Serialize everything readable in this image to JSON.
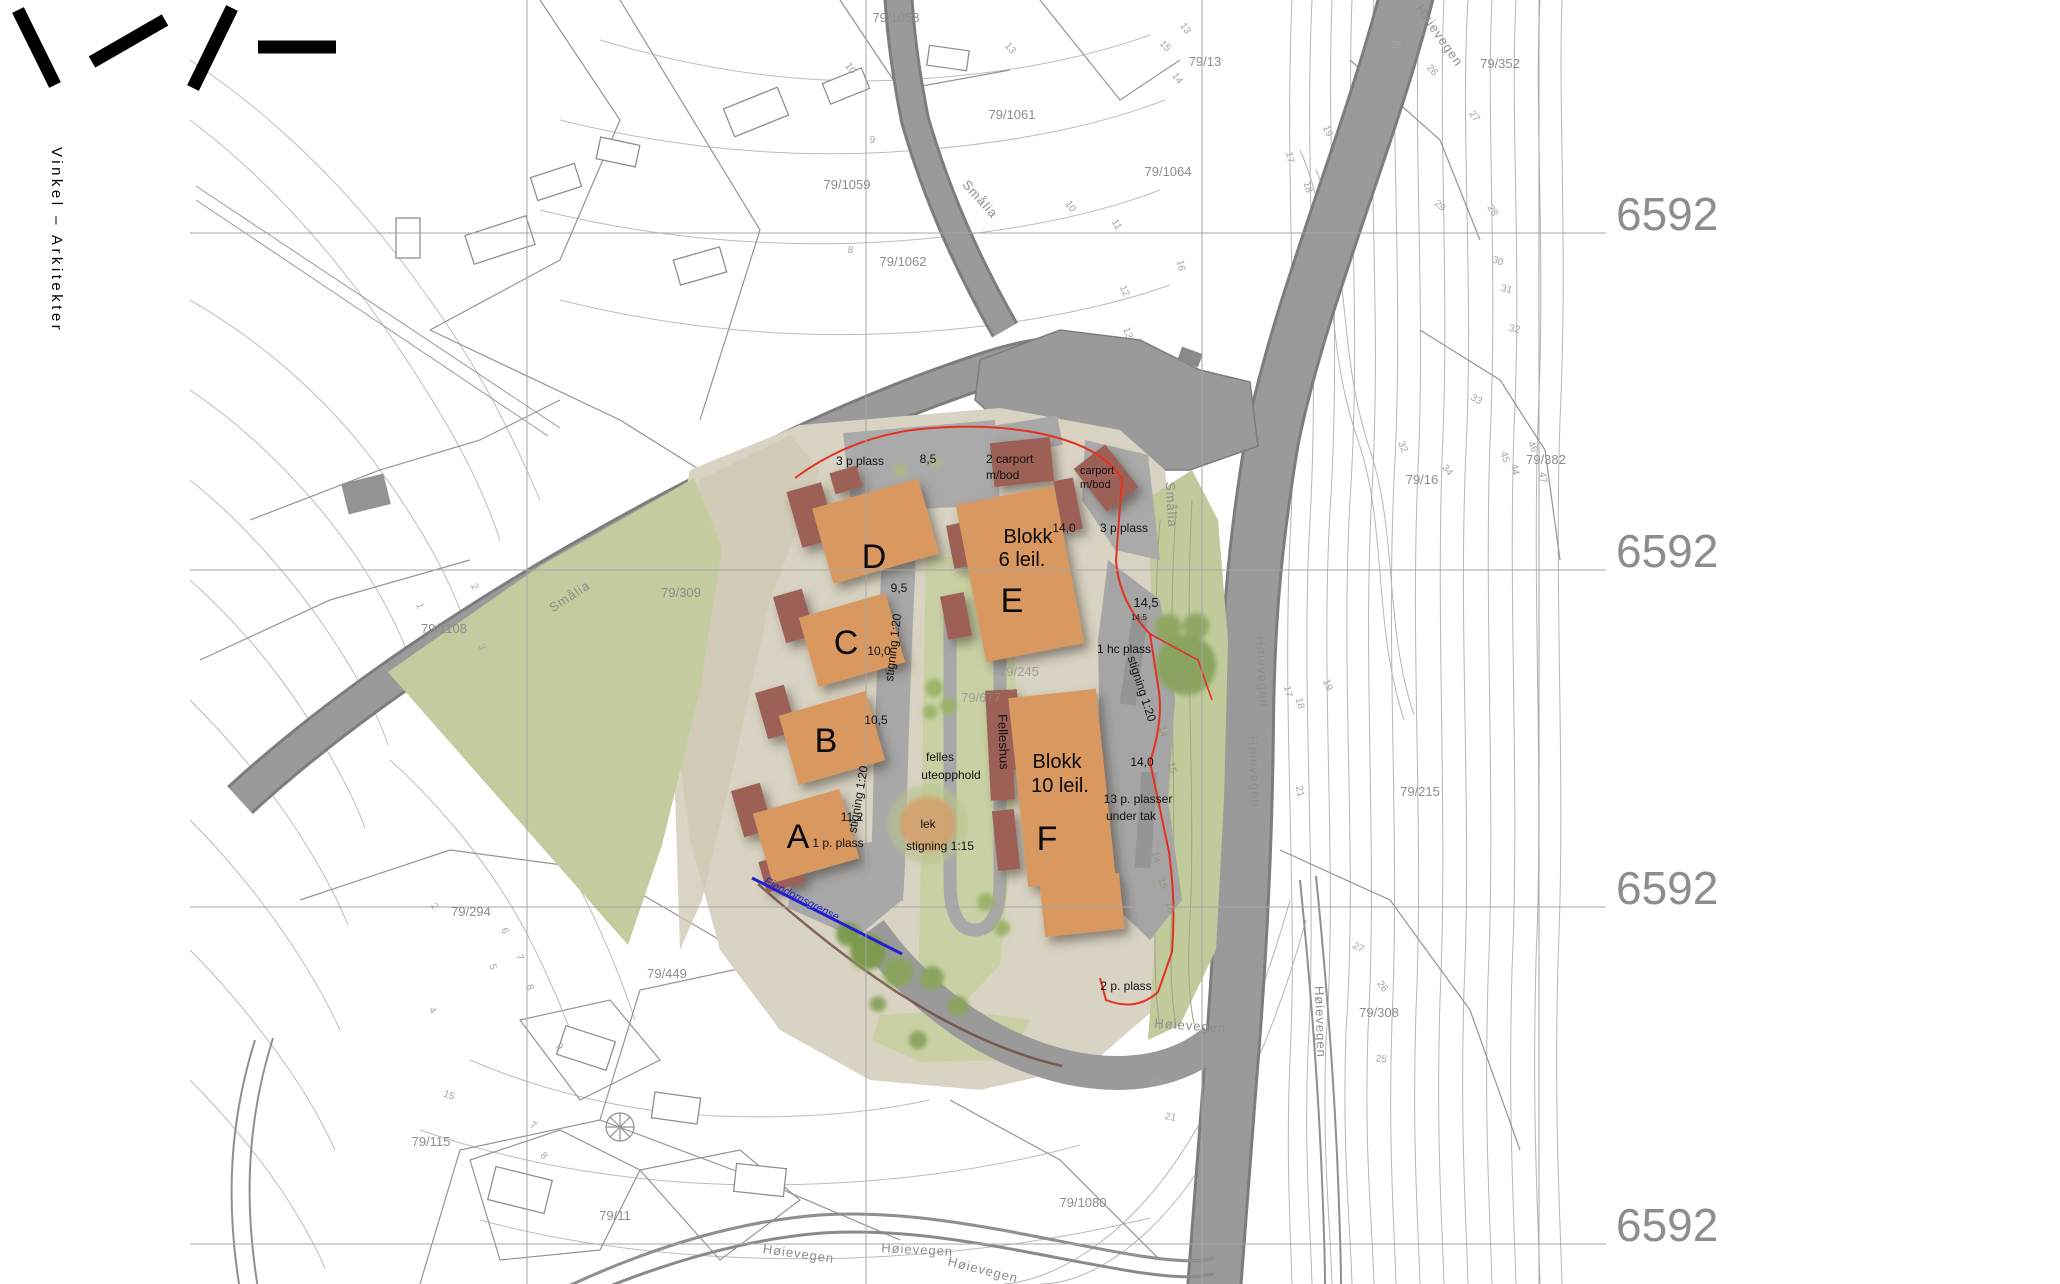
{
  "brand": {
    "studio": "Vinkel – Arkitekter"
  },
  "grid": {
    "labels": [
      {
        "t": "6592"
      },
      {
        "t": "6592"
      },
      {
        "t": "6592"
      },
      {
        "t": "6592"
      }
    ]
  },
  "plan": {
    "building_letters": [
      {
        "t": "D"
      },
      {
        "t": "C"
      },
      {
        "t": "B"
      },
      {
        "t": "A"
      },
      {
        "t": "E"
      },
      {
        "t": "F"
      }
    ],
    "blocks": [
      {
        "line1": "Blokk",
        "line2": "6 leil."
      },
      {
        "line1": "Blokk",
        "line2": "10 leil."
      }
    ],
    "felleshus": "Felleshus",
    "annotations": {
      "p3_top": "3 p plass",
      "h85": "8,5",
      "carport2_l1": "2 carport",
      "carport2_l2": "m/bod",
      "carport_l1": "carport",
      "carport_l2": "m/bod",
      "w140_top": "14,0",
      "p3_right": "3 p plass",
      "h95": "9,5",
      "stigning120_a": "stigning 1:20",
      "h100": "10,0",
      "h105": "10,5",
      "stigning120_b": "stigning 1:20",
      "h112": "11,2",
      "p1": "1 p. plass",
      "felles_l1": "felles",
      "felles_l2": "uteopphold",
      "lek": "lek",
      "stigning115": "stigning 1:15",
      "h145": "14,5",
      "h145_small": "14,5",
      "hc": "1 hc plass",
      "stigning120_c": "stigning 1:20",
      "w140_right": "14,0",
      "p13_l1": "13 p. plasser",
      "p13_l2": "under tak",
      "p2": "2 p. plass",
      "eiendomsgrense": "Eiendomsgrense"
    }
  },
  "parcels": [
    {
      "t": "79/1058"
    },
    {
      "t": "79/13"
    },
    {
      "t": "79/1061"
    },
    {
      "t": "79/1059"
    },
    {
      "t": "79/1062"
    },
    {
      "t": "79/1064"
    },
    {
      "t": "79/352"
    },
    {
      "t": "79/309"
    },
    {
      "t": "79/1108"
    },
    {
      "t": "79/16"
    },
    {
      "t": "79/382"
    },
    {
      "t": "79/215"
    },
    {
      "t": "79/308"
    },
    {
      "t": "79/1080"
    },
    {
      "t": "79/294"
    },
    {
      "t": "79/449"
    },
    {
      "t": "79/115"
    },
    {
      "t": "79/11"
    },
    {
      "t": "79/245"
    },
    {
      "t": "79/677"
    }
  ],
  "road_names": [
    {
      "t": "Smålia"
    },
    {
      "t": "Smålia"
    },
    {
      "t": "Smålia"
    },
    {
      "t": "Høievegen"
    },
    {
      "t": "Høievegen"
    },
    {
      "t": "Høievegen"
    },
    {
      "t": "Høievegen"
    },
    {
      "t": "Høievegen"
    },
    {
      "t": "Høievegen"
    },
    {
      "t": "Høievegen"
    },
    {
      "t": "Høievegen"
    }
  ],
  "contour_labels": [
    {
      "t": "13"
    },
    {
      "t": "14"
    },
    {
      "t": "15"
    },
    {
      "t": "16"
    },
    {
      "t": "10"
    },
    {
      "t": "9"
    },
    {
      "t": "8"
    },
    {
      "t": "13"
    },
    {
      "t": "10"
    },
    {
      "t": "11"
    },
    {
      "t": "12"
    },
    {
      "t": "13"
    },
    {
      "t": "17"
    },
    {
      "t": "18"
    },
    {
      "t": "19"
    },
    {
      "t": "25"
    },
    {
      "t": "26"
    },
    {
      "t": "27"
    },
    {
      "t": "28"
    },
    {
      "t": "29"
    },
    {
      "t": "30"
    },
    {
      "t": "31"
    },
    {
      "t": "32"
    },
    {
      "t": "33"
    },
    {
      "t": "34"
    },
    {
      "t": "44"
    },
    {
      "t": "45"
    },
    {
      "t": "46"
    },
    {
      "t": "47"
    },
    {
      "t": "32"
    },
    {
      "t": "17"
    },
    {
      "t": "18"
    },
    {
      "t": "19"
    },
    {
      "t": "21"
    },
    {
      "t": "20"
    },
    {
      "t": "21"
    },
    {
      "t": "26"
    },
    {
      "t": "27"
    },
    {
      "t": "25"
    },
    {
      "t": "14"
    },
    {
      "t": "15"
    },
    {
      "t": "16"
    },
    {
      "t": "14"
    },
    {
      "t": "15"
    },
    {
      "t": "16"
    },
    {
      "t": "1"
    },
    {
      "t": "2"
    },
    {
      "t": "3"
    },
    {
      "t": "2"
    },
    {
      "t": "4"
    },
    {
      "t": "5"
    },
    {
      "t": "6"
    },
    {
      "t": "7"
    },
    {
      "t": "8"
    },
    {
      "t": "7"
    },
    {
      "t": "8"
    },
    {
      "t": "9"
    },
    {
      "t": "15"
    }
  ],
  "palette": {
    "building_orange": "#d9985e",
    "annex_red": "#9d6156",
    "road_gray": "#9a9a9a",
    "terrain_beige": "#d8d3c2",
    "lawn_green": "#c3cc9e",
    "boundary_red": "#e23222",
    "property_blue": "#2020cf",
    "contour_gray": "#bcbcbc",
    "coordinate_gray": "#8d8d8d"
  }
}
